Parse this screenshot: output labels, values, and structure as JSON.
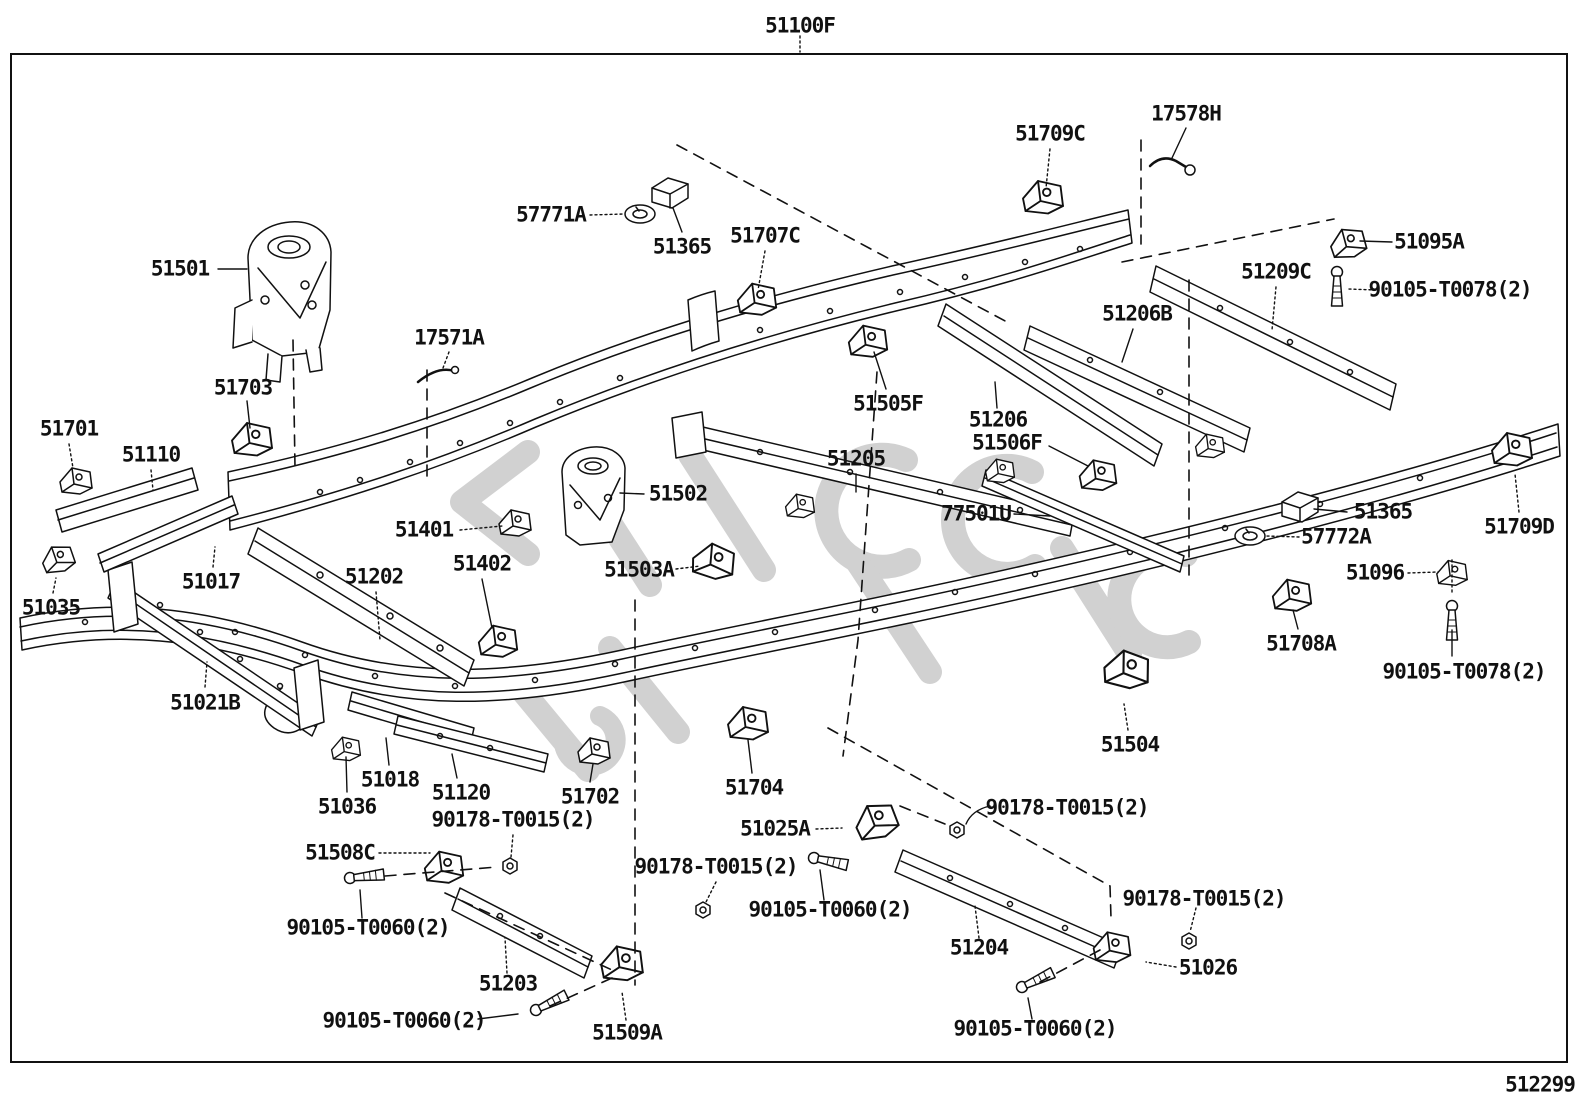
{
  "diagram": {
    "sheet_code": "51100F",
    "drawing_number": "512299",
    "sheet_code_pos": {
      "x": 800,
      "y": 26
    },
    "drawing_number_pos": {
      "x": 1540,
      "y": 1085
    },
    "labels": [
      {
        "text": "17578H",
        "x": 1186,
        "y": 114
      },
      {
        "text": "51709C",
        "x": 1050,
        "y": 134
      },
      {
        "text": "57771A",
        "x": 551,
        "y": 215
      },
      {
        "text": "51707C",
        "x": 765,
        "y": 236
      },
      {
        "text": "51365",
        "x": 682,
        "y": 247
      },
      {
        "text": "51501",
        "x": 180,
        "y": 269
      },
      {
        "text": "51095A",
        "x": 1429,
        "y": 242
      },
      {
        "text": "90105-T0078(2)",
        "x": 1450,
        "y": 290
      },
      {
        "text": "51209C",
        "x": 1276,
        "y": 272
      },
      {
        "text": "51206B",
        "x": 1137,
        "y": 314
      },
      {
        "text": "17571A",
        "x": 449,
        "y": 338
      },
      {
        "text": "51703",
        "x": 243,
        "y": 388
      },
      {
        "text": "51505F",
        "x": 888,
        "y": 404
      },
      {
        "text": "51206",
        "x": 998,
        "y": 420
      },
      {
        "text": "51701",
        "x": 69,
        "y": 429
      },
      {
        "text": "51506F",
        "x": 1007,
        "y": 443
      },
      {
        "text": "51110",
        "x": 151,
        "y": 455
      },
      {
        "text": "51205",
        "x": 856,
        "y": 459
      },
      {
        "text": "51502",
        "x": 678,
        "y": 494
      },
      {
        "text": "77501U",
        "x": 976,
        "y": 514
      },
      {
        "text": "51365",
        "x": 1383,
        "y": 512
      },
      {
        "text": "51709D",
        "x": 1519,
        "y": 527
      },
      {
        "text": "51401",
        "x": 424,
        "y": 530
      },
      {
        "text": "57772A",
        "x": 1336,
        "y": 537
      },
      {
        "text": "51402",
        "x": 482,
        "y": 564
      },
      {
        "text": "51503A",
        "x": 639,
        "y": 570
      },
      {
        "text": "51202",
        "x": 374,
        "y": 577
      },
      {
        "text": "51096",
        "x": 1375,
        "y": 573
      },
      {
        "text": "51017",
        "x": 211,
        "y": 582
      },
      {
        "text": "51035",
        "x": 51,
        "y": 608
      },
      {
        "text": "51708A",
        "x": 1301,
        "y": 644
      },
      {
        "text": "90105-T0078(2)",
        "x": 1464,
        "y": 672
      },
      {
        "text": "51021B",
        "x": 205,
        "y": 703
      },
      {
        "text": "51504",
        "x": 1130,
        "y": 745
      },
      {
        "text": "51018",
        "x": 390,
        "y": 780
      },
      {
        "text": "51120",
        "x": 461,
        "y": 793
      },
      {
        "text": "51702",
        "x": 590,
        "y": 797
      },
      {
        "text": "51704",
        "x": 754,
        "y": 788
      },
      {
        "text": "51036",
        "x": 347,
        "y": 807
      },
      {
        "text": "90178-T0015(2)",
        "x": 1067,
        "y": 808
      },
      {
        "text": "90178-T0015(2)",
        "x": 513,
        "y": 820
      },
      {
        "text": "51025A",
        "x": 775,
        "y": 829
      },
      {
        "text": "51508C",
        "x": 340,
        "y": 853
      },
      {
        "text": "90178-T0015(2)",
        "x": 716,
        "y": 867
      },
      {
        "text": "90178-T0015(2)",
        "x": 1204,
        "y": 899
      },
      {
        "text": "90105-T0060(2)",
        "x": 368,
        "y": 928
      },
      {
        "text": "90105-T0060(2)",
        "x": 830,
        "y": 910
      },
      {
        "text": "51204",
        "x": 979,
        "y": 948
      },
      {
        "text": "51026",
        "x": 1208,
        "y": 968
      },
      {
        "text": "51203",
        "x": 508,
        "y": 984
      },
      {
        "text": "90105-T0060(2)",
        "x": 404,
        "y": 1021
      },
      {
        "text": "51509A",
        "x": 627,
        "y": 1033
      },
      {
        "text": "90105-T0060(2)",
        "x": 1035,
        "y": 1029
      }
    ]
  },
  "colors": {
    "line_color": "#111111",
    "background": "#ffffff",
    "watermark_color": "#c9c9c9"
  }
}
